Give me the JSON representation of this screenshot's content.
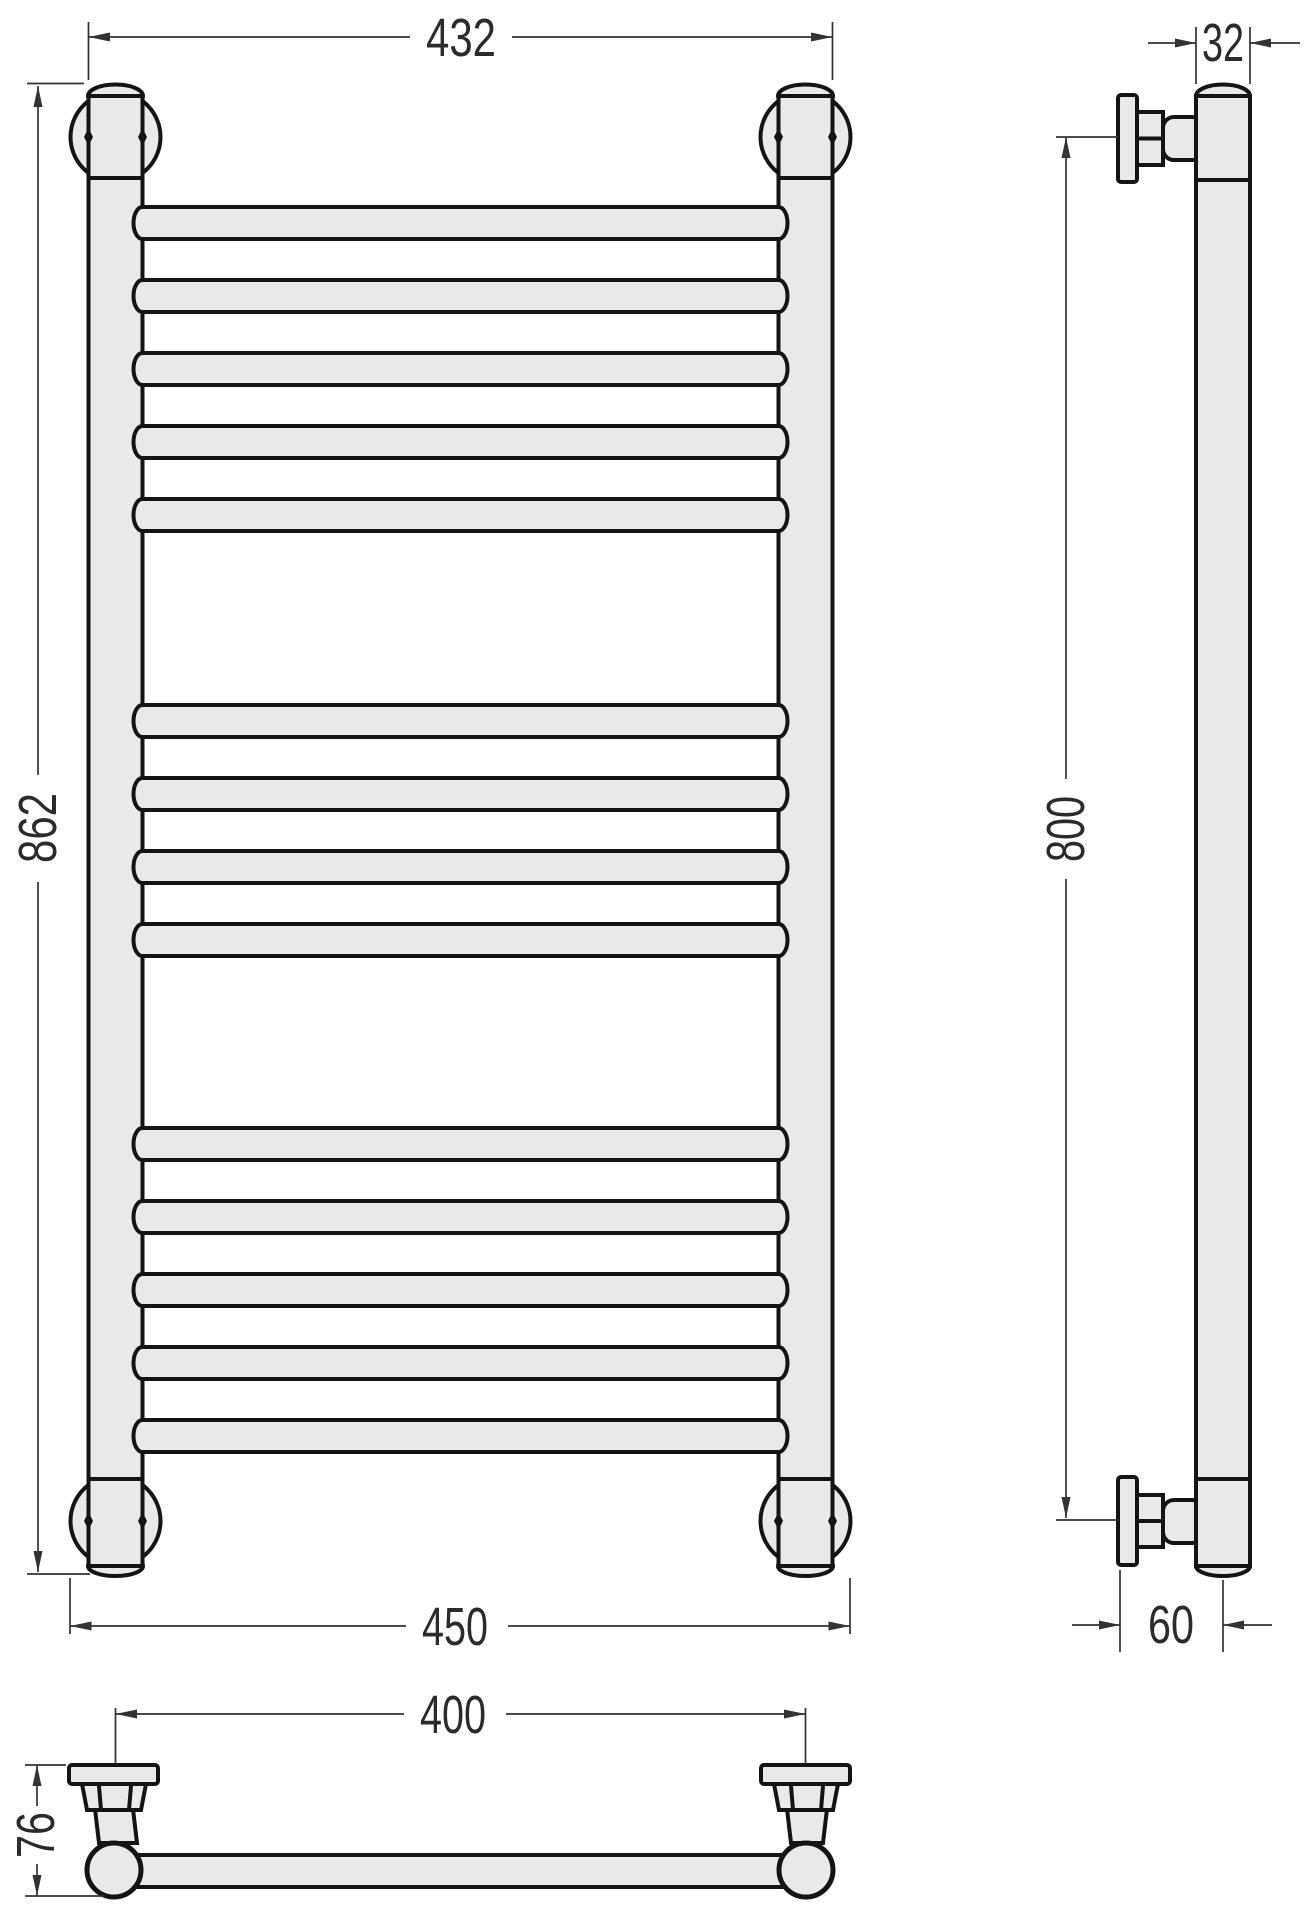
{
  "drawing": {
    "type": "technical-drawing",
    "subject": "ladder towel rail, three orthographic views",
    "units": "mm",
    "colors": {
      "background": "#ffffff",
      "outline": "#141414",
      "part_fill": "#e9e9e9",
      "dimension_lines": "#333333",
      "dimension_text": "#2b2b2b"
    },
    "views": {
      "front": {
        "name": "front-view",
        "rung_groups": [
          5,
          4,
          5
        ],
        "rung_count": 14
      },
      "side": {
        "name": "side-view",
        "brackets": 2
      },
      "bottom": {
        "name": "bottom-view",
        "mounts": 2
      }
    },
    "dimensions": {
      "front_overall_width": "432",
      "front_overall_height": "862",
      "front_mount_outer_width": "450",
      "side_mount_spacing": "800",
      "tube_diameter": "32",
      "wall_offset": "60",
      "bottom_mount_centers": "400",
      "bottom_depth": "76"
    }
  }
}
